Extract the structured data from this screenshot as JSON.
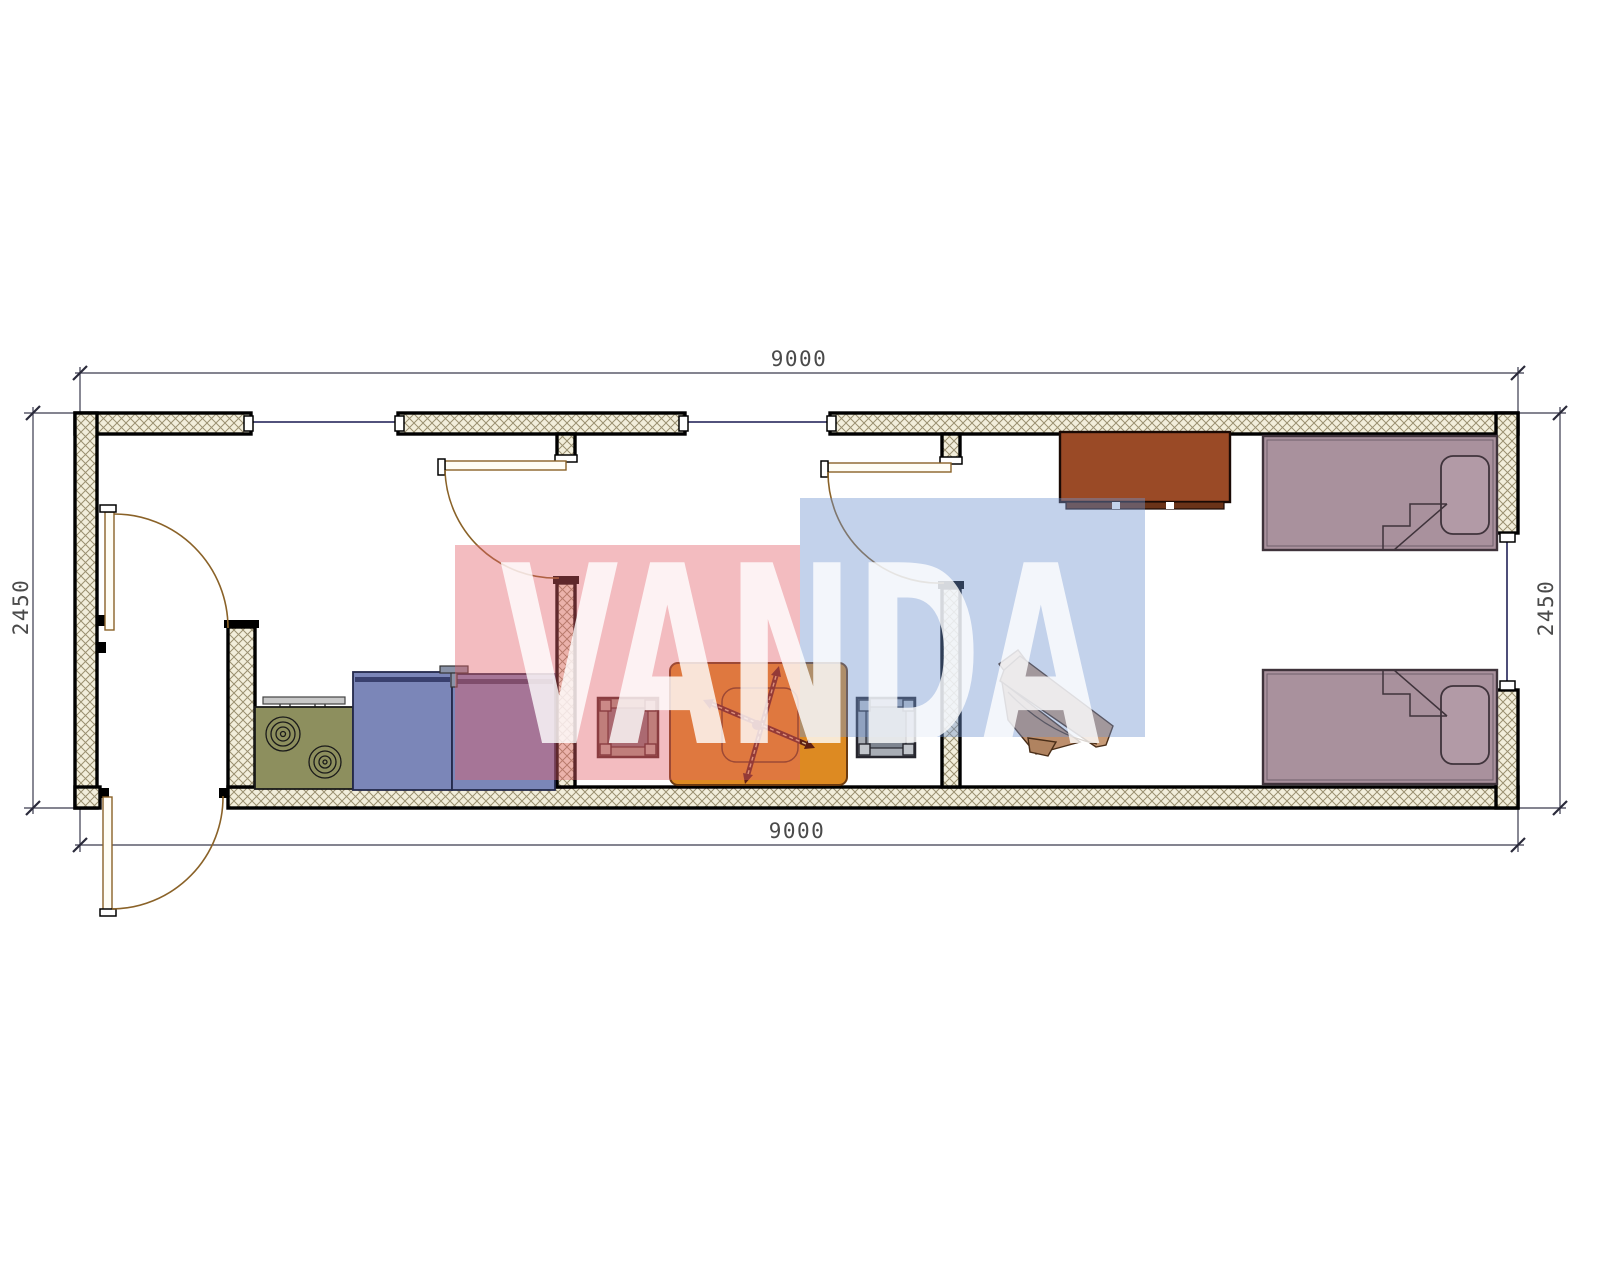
{
  "drawing": {
    "watermark": {
      "text": "VANDA",
      "pink": "#e25f6a",
      "blue": "#6f94cf"
    },
    "dimensions": {
      "top": "9000",
      "bottom": "9000",
      "left": "2450",
      "right": "2450"
    },
    "colors": {
      "wall_hatch_bg": "#f2eedb",
      "wall_hatch_line": "#9a9070",
      "stove_green": "#8d8f5e",
      "cabinet_blue": "#7b86b8",
      "table_orange": "#dd8a22",
      "bed_mauve": "#a9919d",
      "dresser_brown": "#9a4a26",
      "chair_wood": "#c79b77"
    }
  }
}
